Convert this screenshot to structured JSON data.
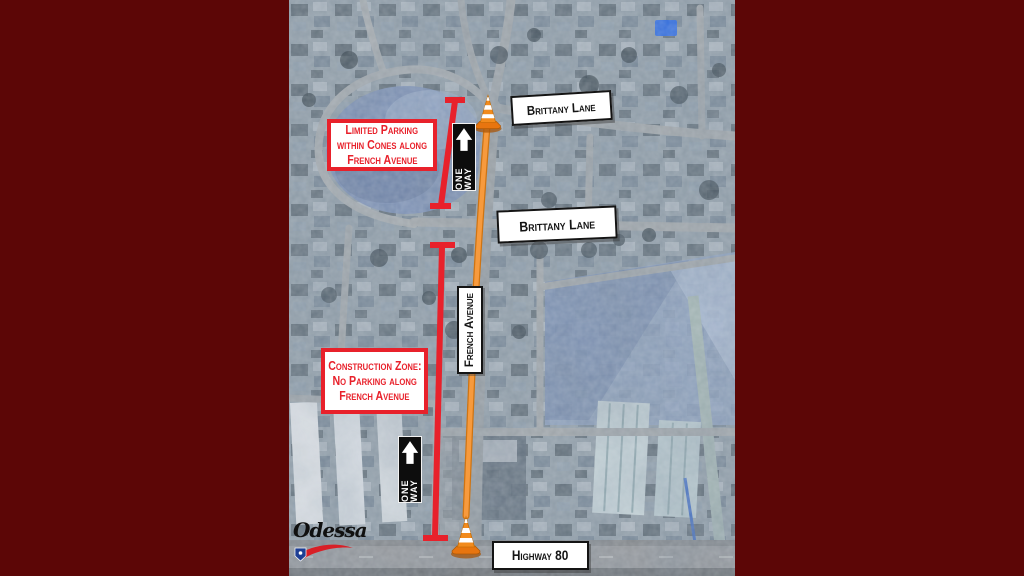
{
  "colors": {
    "background_maroon": "#5c0606",
    "annotation_red": "#e8212b",
    "route_orange": "#f5913a",
    "sign_black": "#0d0d0d",
    "label_white": "#ffffff",
    "pool_blue": "#2a6bea"
  },
  "notes": {
    "limited_parking": {
      "lines": [
        "Limited Parking",
        "within Cones along",
        "French Avenue"
      ]
    },
    "construction_zone": {
      "lines": [
        "Construction Zone:",
        "No Parking along",
        "French Avenue"
      ]
    }
  },
  "street_labels": {
    "brittany_lane_top": "Brittany Lane",
    "brittany_lane_mid": "Brittany Lane",
    "french_avenue": "French Avenue",
    "highway_80": "Highway 80"
  },
  "one_way_sign": {
    "label": "ONE WAY",
    "icon": "up-arrow-icon"
  },
  "map_markers": {
    "cone_icon": "traffic-cone-icon",
    "zone_line_icon": "red-extent-bar-icon"
  },
  "logo": {
    "text": "Odessa"
  }
}
